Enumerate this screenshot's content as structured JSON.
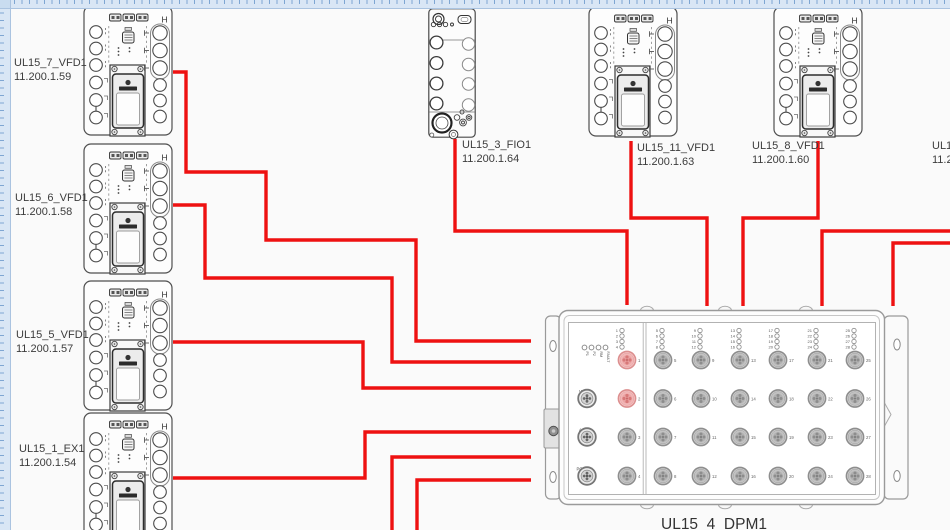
{
  "colors": {
    "wire": "#ee1111",
    "ruler_bg": "#d9e6f5",
    "ruler_tick": "#7fa6d2",
    "sheet_bg": "#fafafa",
    "outline": "#4f4f4f",
    "label_text": "#3c3c3c",
    "port_red_ring": "#dc8f8f",
    "port_red_fill": "#f7caca",
    "port_gray_ring": "#8e8e8e",
    "port_gray_fill": "#d6d6d6"
  },
  "vfd_marking": "H",
  "left_devices": [
    {
      "name": "UL15_7_VFD1",
      "ip": "11.200.1.59"
    },
    {
      "name": "UL15_6_VFD1",
      "ip": "11.200.1.58"
    },
    {
      "name": "UL15_5_VFD1",
      "ip": "11.200.1.57"
    },
    {
      "name": "UL15_1_EX1",
      "ip": "11.200.1.54"
    }
  ],
  "top_devices": [
    {
      "name": "UL15_3_FIO1",
      "ip": "11.200.1.64"
    },
    {
      "name": "UL15_11_VFD1",
      "ip": "11.200.1.63"
    },
    {
      "name": "UL15_8_VFD1",
      "ip": "11.200.1.60"
    },
    {
      "name": "UL15",
      "ip": "11.2"
    }
  ],
  "switch": {
    "name": "UL15_4_DPM1",
    "status_leds": [
      "P1",
      "P2",
      "RM",
      "FAULT"
    ],
    "aux_connectors": [
      "V.24",
      "ACA",
      "POWER"
    ],
    "port_count": 28,
    "highlighted_ports": [
      1,
      2
    ]
  },
  "wires": [
    {
      "from": "UL15_7_VFD1",
      "to": "UL15_4_DPM1",
      "points": [
        [
          173,
          72
        ],
        [
          186,
          72
        ],
        [
          186,
          172
        ],
        [
          266,
          172
        ],
        [
          266,
          240
        ],
        [
          416,
          240
        ],
        [
          416,
          341
        ],
        [
          531,
          341
        ]
      ]
    },
    {
      "from": "UL15_6_VFD1",
      "to": "UL15_4_DPM1",
      "points": [
        [
          173,
          205
        ],
        [
          205,
          205
        ],
        [
          205,
          278
        ],
        [
          392,
          278
        ],
        [
          392,
          362
        ],
        [
          531,
          362
        ]
      ]
    },
    {
      "from": "UL15_5_VFD1",
      "to": "UL15_4_DPM1",
      "points": [
        [
          173,
          342
        ],
        [
          363,
          342
        ],
        [
          363,
          388
        ],
        [
          531,
          388
        ]
      ]
    },
    {
      "from": "UL15_1_EX1",
      "to": "UL15_4_DPM1",
      "points": [
        [
          173,
          478
        ],
        [
          365,
          478
        ],
        [
          365,
          432
        ],
        [
          531,
          432
        ]
      ]
    },
    {
      "from": "offscreen-bottom",
      "to": "UL15_4_DPM1",
      "points": [
        [
          392,
          532
        ],
        [
          392,
          457
        ],
        [
          531,
          457
        ]
      ]
    },
    {
      "from": "offscreen-bottom",
      "to": "UL15_4_DPM1",
      "points": [
        [
          417,
          532
        ],
        [
          417,
          480
        ],
        [
          531,
          480
        ]
      ]
    },
    {
      "from": "UL15_3_FIO1",
      "to": "UL15_4_DPM1",
      "points": [
        [
          455,
          139
        ],
        [
          455,
          231
        ],
        [
          627,
          231
        ],
        [
          627,
          305
        ]
      ]
    },
    {
      "from": "UL15_11_VFD1",
      "to": "UL15_4_DPM1",
      "points": [
        [
          631,
          141
        ],
        [
          631,
          218
        ],
        [
          707,
          218
        ],
        [
          707,
          306
        ]
      ]
    },
    {
      "from": "UL15_8_VFD1",
      "to": "UL15_4_DPM1",
      "points": [
        [
          818,
          141
        ],
        [
          818,
          218
        ],
        [
          743,
          218
        ],
        [
          743,
          306
        ]
      ]
    },
    {
      "from": "offscreen-right",
      "to": "UL15_4_DPM1",
      "points": [
        [
          952,
          231
        ],
        [
          822,
          231
        ],
        [
          822,
          306
        ]
      ]
    },
    {
      "from": "offscreen-right",
      "to": "UL15_4_DPM1",
      "points": [
        [
          952,
          243
        ],
        [
          893,
          243
        ],
        [
          893,
          306
        ]
      ]
    }
  ]
}
